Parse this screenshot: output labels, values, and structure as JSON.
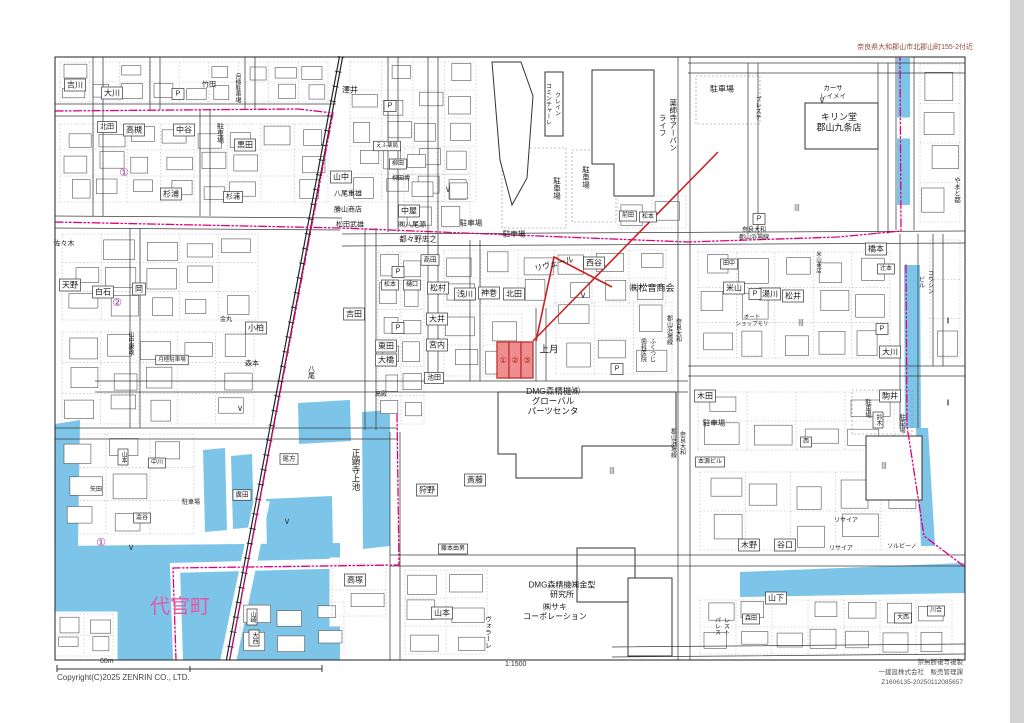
{
  "header": {
    "area_title": "奈良県大和郡山市北郡山町155-2付近"
  },
  "footer": {
    "copyright": "Copyright(C)2025 ZENRIN CO., LTD.",
    "scale_ratio": "1:1500",
    "scale_distance": "60m",
    "notice_line1": "禁無断複写複製",
    "notice_line2": "一建設株式会社　販売管理課",
    "notice_line3": "Z1606135-20250112085657"
  },
  "colors": {
    "water": "#7cc4e8",
    "boundary_pink": "#e0007d",
    "town_label_pink": "#e558a8",
    "highlight_fill": "#ef8e8e",
    "highlight_stroke": "#c23b3b",
    "leader_red": "#cc2222",
    "circled_purple": "#9b2f9b"
  },
  "highlight": {
    "parcels": [
      "①",
      "②",
      "③"
    ],
    "x": 497,
    "y": 342,
    "cell_w": 12,
    "cell_h": 36
  },
  "map_labels": [
    {
      "t": "吉川",
      "x": 75,
      "y": 85,
      "b": 1
    },
    {
      "t": "大川",
      "x": 112,
      "y": 93,
      "b": 1
    },
    {
      "t": "竹田",
      "x": 209,
      "y": 85,
      "s": 7
    },
    {
      "t": "澤井",
      "x": 350,
      "y": 90
    },
    {
      "t": "月極駐車場",
      "x": 237,
      "y": 88,
      "v": 1,
      "s": 6
    },
    {
      "t": "北田",
      "x": 107,
      "y": 127,
      "b": 1,
      "s": 7
    },
    {
      "t": "高槻",
      "x": 134,
      "y": 130,
      "b": 1
    },
    {
      "t": "中谷",
      "x": 184,
      "y": 130,
      "b": 1
    },
    {
      "t": "駐車場",
      "x": 220,
      "y": 133,
      "v": 1,
      "s": 7
    },
    {
      "t": "黒田",
      "x": 245,
      "y": 145,
      "b": 1
    },
    {
      "t": "杉浦",
      "x": 171,
      "y": 194,
      "b": 1
    },
    {
      "t": "杉浦",
      "x": 233,
      "y": 197,
      "b": 1,
      "s": 7
    },
    {
      "t": "山中",
      "x": 341,
      "y": 177,
      "b": 1
    },
    {
      "t": "八尾重雄",
      "x": 348,
      "y": 194,
      "s": 7
    },
    {
      "t": "勝山商店",
      "x": 348,
      "y": 210,
      "s": 7
    },
    {
      "t": "松田武雄",
      "x": 350,
      "y": 225,
      "s": 7
    },
    {
      "t": "佐々木",
      "x": 64,
      "y": 244,
      "s": 7
    },
    {
      "t": "①",
      "x": 124,
      "y": 173,
      "s": 11,
      "c": "#9b2f9b"
    },
    {
      "t": "②",
      "x": 117,
      "y": 303,
      "s": 11,
      "c": "#9b2f9b"
    },
    {
      "t": "①",
      "x": 101,
      "y": 543,
      "s": 11,
      "c": "#9b2f9b"
    },
    {
      "t": "天野",
      "x": 70,
      "y": 285,
      "b": 1
    },
    {
      "t": "白石",
      "x": 103,
      "y": 292,
      "b": 1
    },
    {
      "t": "岡",
      "x": 139,
      "y": 289,
      "b": 1
    },
    {
      "t": "小柏",
      "x": 256,
      "y": 328,
      "b": 1
    },
    {
      "t": "森本",
      "x": 252,
      "y": 364,
      "s": 7
    },
    {
      "t": "金丸",
      "x": 226,
      "y": 320,
      "s": 6
    },
    {
      "t": "月極駐車場",
      "x": 172,
      "y": 360,
      "s": 5.5,
      "b": 1
    },
    {
      "t": "山中康政",
      "x": 130,
      "y": 343,
      "v": 1,
      "s": 6
    },
    {
      "t": "吉田",
      "x": 354,
      "y": 314,
      "b": 1
    },
    {
      "t": "東田",
      "x": 386,
      "y": 346,
      "b": 1
    },
    {
      "t": "大橋",
      "x": 386,
      "y": 360,
      "b": 1
    },
    {
      "t": "八尾",
      "x": 311,
      "y": 372,
      "v": 1,
      "s": 7
    },
    {
      "t": "高殿",
      "x": 381,
      "y": 395,
      "s": 6
    },
    {
      "t": "えふ薬局",
      "x": 387,
      "y": 146,
      "s": 5.5,
      "b": 1
    },
    {
      "t": "柳田",
      "x": 398,
      "y": 164,
      "s": 6,
      "b": 1
    },
    {
      "t": "柳田博",
      "x": 401,
      "y": 179,
      "s": 6
    },
    {
      "t": "中屋",
      "x": 409,
      "y": 211,
      "b": 1
    },
    {
      "t": "㈱八尾源",
      "x": 412,
      "y": 225,
      "s": 7
    },
    {
      "t": "都々野忠之",
      "x": 418,
      "y": 239,
      "s": 7.5
    },
    {
      "t": "駐車場",
      "x": 471,
      "y": 223,
      "s": 7.5
    },
    {
      "t": "駐車場",
      "x": 514,
      "y": 234,
      "s": 7.5
    },
    {
      "t": "駐車場",
      "x": 557,
      "y": 188,
      "v": 1,
      "s": 7.5
    },
    {
      "t": "駐車場",
      "x": 586,
      "y": 177,
      "v": 1,
      "s": 7.5
    },
    {
      "t": "プレステ",
      "x": 757,
      "y": 108,
      "v": 1,
      "s": 6
    },
    {
      "t": "クレイン\nコミンチャーレ",
      "x": 552,
      "y": 104,
      "v": 1,
      "s": 6
    },
    {
      "t": "薬師寺アーバン\nライフ",
      "x": 668,
      "y": 125,
      "v": 1,
      "s": 7.5
    },
    {
      "t": "カーサ\nレイメイ",
      "x": 833,
      "y": 92,
      "s": 6.5
    },
    {
      "t": "キリン堂\n郡山九条店",
      "x": 839,
      "y": 122,
      "s": 9
    },
    {
      "t": "駐車場",
      "x": 722,
      "y": 89
    },
    {
      "t": "前田",
      "x": 628,
      "y": 216,
      "s": 6,
      "b": 1
    },
    {
      "t": "松本",
      "x": 648,
      "y": 217,
      "s": 6,
      "b": 1
    },
    {
      "t": "松本",
      "x": 390,
      "y": 285,
      "s": 6,
      "b": 1
    },
    {
      "t": "樋口",
      "x": 412,
      "y": 285,
      "s": 6,
      "b": 1
    },
    {
      "t": "奈良大和\n郡山浜場線",
      "x": 754,
      "y": 234,
      "s": 6
    },
    {
      "t": "奈良大和\n郡山浜場線",
      "x": 673,
      "y": 330,
      "v": 1,
      "s": 6
    },
    {
      "t": "奈良大和\n郡山浜場線",
      "x": 677,
      "y": 443,
      "v": 1,
      "s": 6
    },
    {
      "t": "橋本",
      "x": 876,
      "y": 249,
      "b": 1
    },
    {
      "t": "田中",
      "x": 729,
      "y": 264,
      "s": 6,
      "b": 1
    },
    {
      "t": "米山",
      "x": 734,
      "y": 288,
      "b": 1
    },
    {
      "t": "湯川",
      "x": 770,
      "y": 294,
      "b": 1
    },
    {
      "t": "松井",
      "x": 793,
      "y": 296,
      "b": 1
    },
    {
      "t": "辻本",
      "x": 886,
      "y": 269,
      "s": 6,
      "b": 1
    },
    {
      "t": "コウシン\nビル",
      "x": 925,
      "y": 282,
      "v": 1,
      "s": 6
    },
    {
      "t": "やまと都",
      "x": 956,
      "y": 190,
      "v": 1,
      "s": 6.5
    },
    {
      "t": "大川",
      "x": 890,
      "y": 352,
      "b": 1
    },
    {
      "t": "オート\nショップモリ",
      "x": 752,
      "y": 321,
      "s": 5.5
    },
    {
      "t": "米山商店",
      "x": 818,
      "y": 262,
      "v": 1,
      "s": 5.5
    },
    {
      "t": "高田",
      "x": 430,
      "y": 260,
      "s": 6.5,
      "b": 1
    },
    {
      "t": "松村",
      "x": 438,
      "y": 288,
      "b": 1
    },
    {
      "t": "大井",
      "x": 437,
      "y": 319,
      "b": 1
    },
    {
      "t": "宮内",
      "x": 437,
      "y": 345,
      "b": 1
    },
    {
      "t": "池田",
      "x": 434,
      "y": 378,
      "s": 7,
      "b": 1
    },
    {
      "t": "浅川",
      "x": 465,
      "y": 294,
      "b": 1
    },
    {
      "t": "神巻",
      "x": 489,
      "y": 293,
      "b": 1
    },
    {
      "t": "北田",
      "x": 514,
      "y": 294,
      "b": 1
    },
    {
      "t": "リヴェール",
      "x": 554,
      "y": 264,
      "r": -14
    },
    {
      "t": "西谷",
      "x": 594,
      "y": 263,
      "b": 1
    },
    {
      "t": "㈱松音商会",
      "x": 652,
      "y": 288,
      "s": 9
    },
    {
      "t": "上月",
      "x": 549,
      "y": 350,
      "s": 9.5
    },
    {
      "t": "ふくつじ\n歯科医院",
      "x": 647,
      "y": 350,
      "v": 1,
      "s": 6
    },
    {
      "t": "DMG森精機㈱\nグローバル\nパーツセンタ",
      "x": 553,
      "y": 401,
      "s": 8.5
    },
    {
      "t": "斎藤",
      "x": 475,
      "y": 480,
      "b": 1
    },
    {
      "t": "狩野",
      "x": 427,
      "y": 490,
      "b": 1
    },
    {
      "t": "藤本由男",
      "x": 453,
      "y": 549,
      "s": 6,
      "b": 1
    },
    {
      "t": "DMG森精機㈱金型\n研究所",
      "x": 562,
      "y": 589,
      "s": 8
    },
    {
      "t": "㈱サキ\nコーポレーション",
      "x": 555,
      "y": 611,
      "s": 8
    },
    {
      "t": "山本",
      "x": 442,
      "y": 613,
      "b": 1
    },
    {
      "t": "ヴォラーレ",
      "x": 487,
      "y": 632,
      "v": 1,
      "s": 6.5
    },
    {
      "t": "木田",
      "x": 705,
      "y": 396,
      "b": 1
    },
    {
      "t": "駐車場",
      "x": 714,
      "y": 423,
      "s": 7.5
    },
    {
      "t": "駒井",
      "x": 890,
      "y": 396,
      "b": 1
    },
    {
      "t": "鈴木",
      "x": 878,
      "y": 420,
      "v": 1,
      "s": 6,
      "b": 1
    },
    {
      "t": "駐車場",
      "x": 867,
      "y": 408,
      "v": 1,
      "s": 6.5
    },
    {
      "t": "駐車場",
      "x": 901,
      "y": 423,
      "v": 1,
      "s": 6.5
    },
    {
      "t": "本源ビル",
      "x": 710,
      "y": 462,
      "s": 6,
      "b": 1
    },
    {
      "t": "木野",
      "x": 749,
      "y": 545,
      "b": 1
    },
    {
      "t": "谷口",
      "x": 785,
      "y": 545,
      "b": 1
    },
    {
      "t": "リサイア",
      "x": 846,
      "y": 521,
      "s": 6
    },
    {
      "t": "リサイア",
      "x": 841,
      "y": 549,
      "s": 6
    },
    {
      "t": "ソルビーノ",
      "x": 902,
      "y": 547,
      "s": 6
    },
    {
      "t": "西",
      "x": 806,
      "y": 442,
      "s": 6,
      "b": 1
    },
    {
      "t": "正顕寺上池",
      "x": 356,
      "y": 470,
      "v": 1,
      "s": 8.5
    },
    {
      "t": "高塚",
      "x": 355,
      "y": 580,
      "b": 1
    },
    {
      "t": "代官町",
      "x": 180,
      "y": 607,
      "s": 20,
      "c": "#e558a8"
    },
    {
      "t": "山崎",
      "x": 252,
      "y": 617,
      "v": 1,
      "s": 6,
      "b": 1
    },
    {
      "t": "大西",
      "x": 254,
      "y": 638,
      "v": 1,
      "s": 6,
      "b": 1
    },
    {
      "t": "尾方",
      "x": 289,
      "y": 459,
      "s": 6.5,
      "b": 1
    },
    {
      "t": "廣田",
      "x": 242,
      "y": 495,
      "s": 6.5,
      "b": 1
    },
    {
      "t": "駐車場",
      "x": 191,
      "y": 503,
      "s": 6
    },
    {
      "t": "山本",
      "x": 123,
      "y": 457,
      "v": 1,
      "s": 6,
      "b": 1
    },
    {
      "t": "中川",
      "x": 157,
      "y": 463,
      "s": 6,
      "b": 1
    },
    {
      "t": "澁谷",
      "x": 142,
      "y": 518,
      "s": 6,
      "b": 1
    },
    {
      "t": "矢田",
      "x": 96,
      "y": 490,
      "s": 6
    },
    {
      "t": "山下",
      "x": 776,
      "y": 598,
      "b": 1
    },
    {
      "t": "レスト\nパレス",
      "x": 721,
      "y": 626,
      "v": 1,
      "s": 6
    },
    {
      "t": "森田",
      "x": 751,
      "y": 619,
      "s": 6,
      "b": 1
    },
    {
      "t": "大西",
      "x": 903,
      "y": 618,
      "s": 6,
      "b": 1
    },
    {
      "t": "川合",
      "x": 936,
      "y": 611,
      "s": 6,
      "b": 1
    },
    {
      "t": "∨",
      "x": 583,
      "y": 295,
      "s": 9,
      "c": "#444"
    },
    {
      "t": "∨",
      "x": 240,
      "y": 408,
      "s": 9,
      "c": "#444"
    },
    {
      "t": "∨",
      "x": 822,
      "y": 100,
      "s": 9,
      "c": "#444"
    },
    {
      "t": "∨",
      "x": 287,
      "y": 521,
      "s": 9,
      "c": "#444"
    },
    {
      "t": "∨",
      "x": 448,
      "y": 189,
      "s": 9,
      "c": "#444"
    },
    {
      "t": "∨",
      "x": 131,
      "y": 547,
      "s": 9,
      "c": "#444"
    },
    {
      "t": "|||",
      "x": 797,
      "y": 208,
      "s": 7,
      "c": "#444"
    },
    {
      "t": "|||",
      "x": 801,
      "y": 323,
      "s": 7,
      "c": "#444"
    },
    {
      "t": "|||",
      "x": 884,
      "y": 466,
      "s": 7,
      "c": "#444"
    },
    {
      "t": "|||",
      "x": 612,
      "y": 471,
      "s": 7,
      "c": "#444"
    },
    {
      "t": "‖",
      "x": 948,
      "y": 321,
      "s": 8,
      "c": "#444"
    },
    {
      "t": "‖",
      "x": 948,
      "y": 403,
      "s": 8,
      "c": "#444"
    },
    {
      "t": "P",
      "x": 398,
      "y": 272,
      "b": 1,
      "s": 7
    },
    {
      "t": "P",
      "x": 398,
      "y": 328,
      "b": 1,
      "s": 7
    },
    {
      "t": "P",
      "x": 390,
      "y": 106,
      "b": 1,
      "s": 7
    },
    {
      "t": "P",
      "x": 759,
      "y": 219,
      "b": 1,
      "s": 7
    },
    {
      "t": "P",
      "x": 617,
      "y": 369,
      "b": 1,
      "s": 7
    },
    {
      "t": "P",
      "x": 755,
      "y": 294,
      "b": 1,
      "s": 7
    },
    {
      "t": "P",
      "x": 882,
      "y": 329,
      "b": 1,
      "s": 7
    },
    {
      "t": "P",
      "x": 178,
      "y": 94,
      "b": 1,
      "s": 7
    }
  ]
}
